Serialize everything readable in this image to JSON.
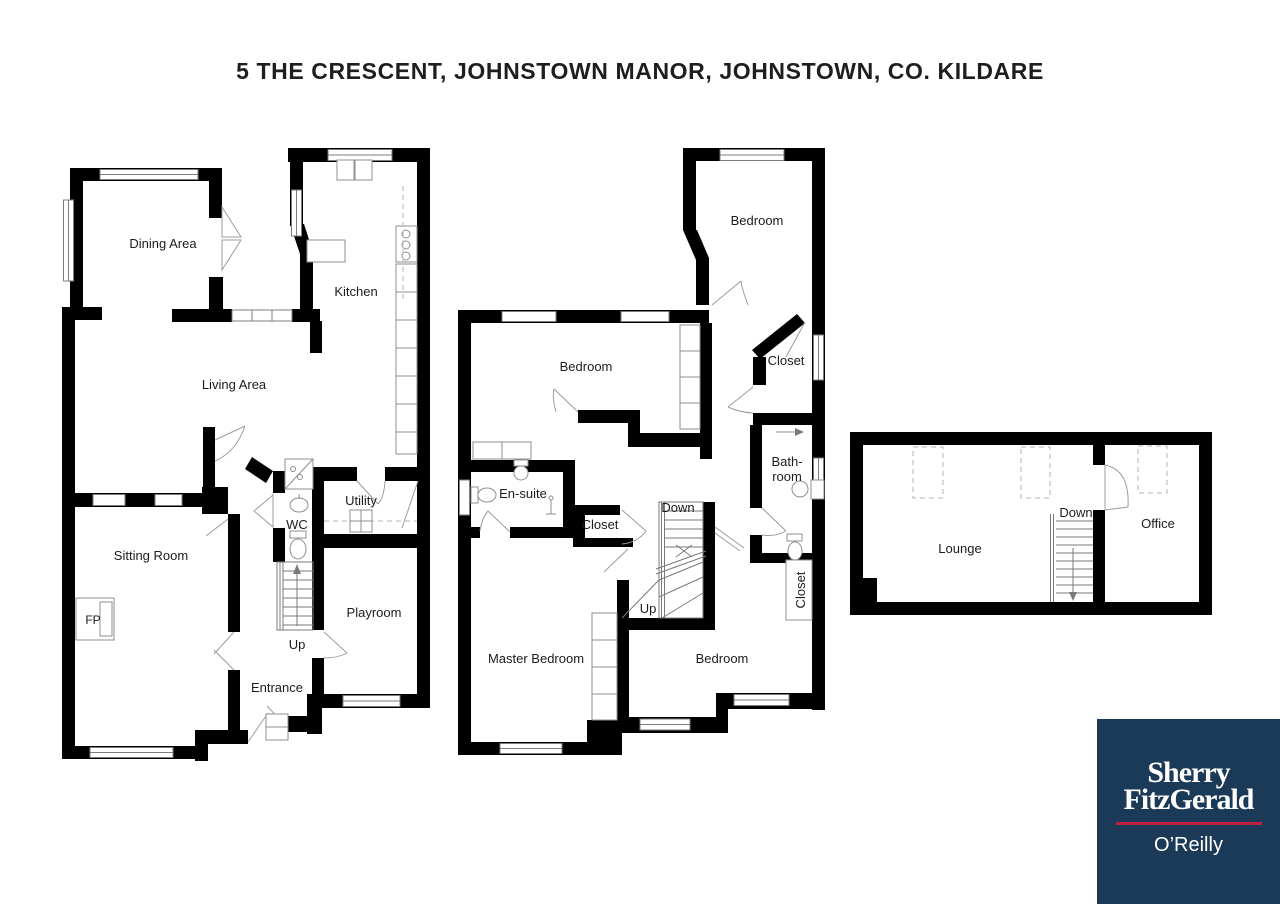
{
  "title": "5 THE CRESCENT, JOHNSTOWN MANOR, JOHNSTOWN, CO. KILDARE",
  "ground_floor": {
    "dining_area": "Dining Area",
    "kitchen": "Kitchen",
    "living_area": "Living Area",
    "sitting_room": "Sitting Room",
    "fireplace": "FP",
    "wc": "WC",
    "utility": "Utility",
    "stairs_up": "Up",
    "playroom": "Playroom",
    "entrance": "Entrance"
  },
  "first_floor": {
    "bedroom_rear": "Bedroom",
    "bedroom_middle": "Bedroom",
    "closet_rear": "Closet",
    "ensuite": "En-suite",
    "closet_landing": "Closet",
    "bathroom_line1": "Bath-",
    "bathroom_line2": "room",
    "closet_side": "Closet",
    "stairs_down": "Down",
    "stairs_up": "Up",
    "master_bedroom": "Master Bedroom",
    "bedroom_front": "Bedroom"
  },
  "second_floor": {
    "lounge": "Lounge",
    "office": "Office",
    "stairs_down": "Down"
  },
  "logo": {
    "line1": "Sherry",
    "line2": "FitzGerald",
    "line3": "O’Reilly",
    "background": "#1b3a57",
    "accent": "#c01f3f"
  }
}
